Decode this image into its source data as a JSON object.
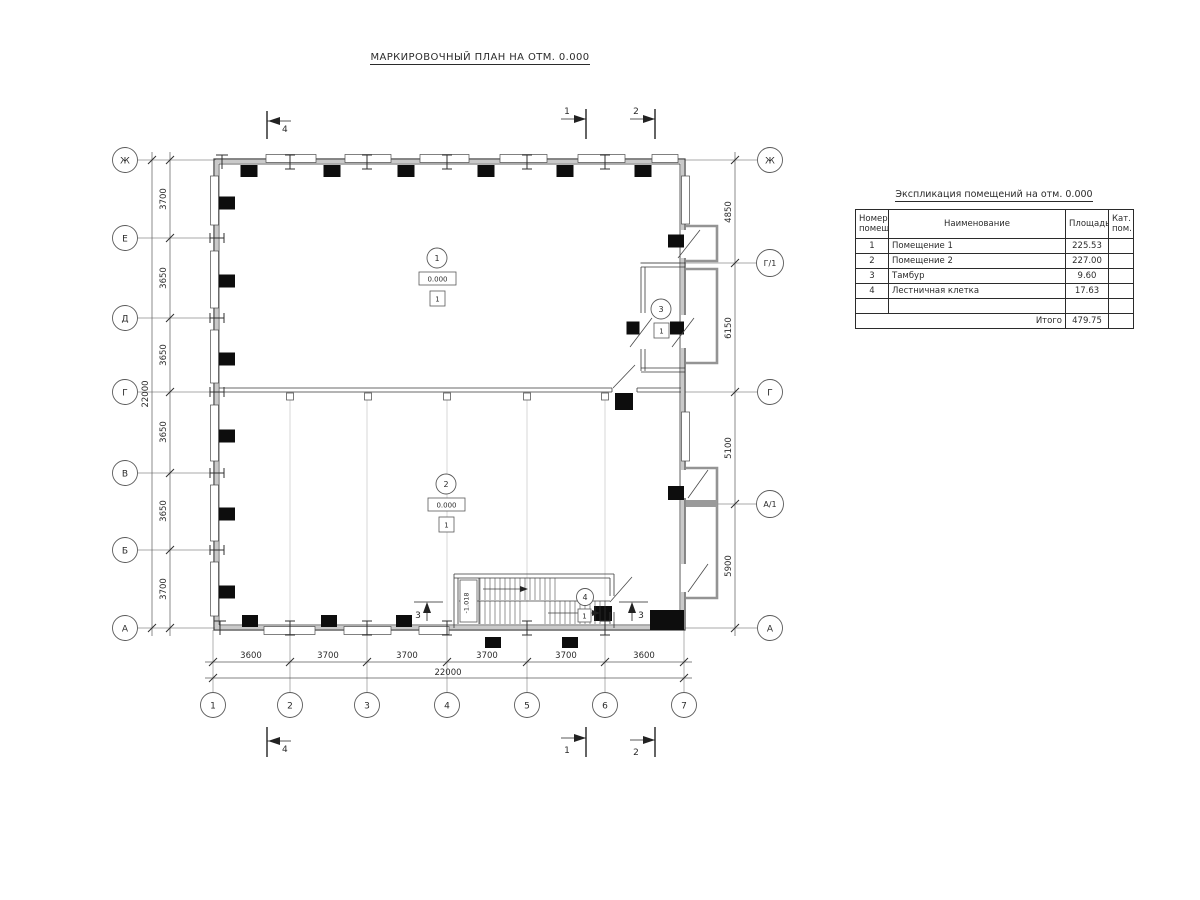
{
  "title": "МАРКИРОВОЧНЫЙ ПЛАН НА ОТМ. 0.000",
  "axes": {
    "left": [
      "Ж",
      "Е",
      "Д",
      "Г",
      "В",
      "Б",
      "А"
    ],
    "right": [
      "Ж",
      "Г/1",
      "Г",
      "А/1",
      "А"
    ],
    "bottom": [
      "1",
      "2",
      "3",
      "4",
      "5",
      "6",
      "7"
    ]
  },
  "dims": {
    "left": [
      "3700",
      "3650",
      "3650",
      "3650",
      "3650",
      "3700"
    ],
    "left_total": "22000",
    "right": [
      "4850",
      "6150",
      "5100",
      "5900"
    ],
    "bottom": [
      "3600",
      "3700",
      "3700",
      "3700",
      "3700",
      "3600"
    ],
    "bottom_total": "22000"
  },
  "rooms": {
    "r1": {
      "num": "1",
      "elev": "0.000",
      "floor": "1"
    },
    "r2": {
      "num": "2",
      "elev": "0.000",
      "floor": "1"
    },
    "r3": {
      "num": "3",
      "floor": "1"
    },
    "r4": {
      "num": "4",
      "floor": "1"
    }
  },
  "stair": {
    "landing_elevation": "-1.018"
  },
  "sections": {
    "s1": "1",
    "s2": "2",
    "s3": "3",
    "s4": "4"
  },
  "table": {
    "title": "Экспликация помещений на отм. 0.000",
    "headers": {
      "number": "Номер помещ.",
      "name": "Наименование",
      "area": "Площадь",
      "category": "Кат. пом."
    },
    "rows": [
      {
        "number": "1",
        "name": "Помещение 1",
        "area": "225.53",
        "category": ""
      },
      {
        "number": "2",
        "name": "Помещение 2",
        "area": "227.00",
        "category": ""
      },
      {
        "number": "3",
        "name": "Тамбур",
        "area": "9.60",
        "category": ""
      },
      {
        "number": "4",
        "name": "Лестничная клетка",
        "area": "17.63",
        "category": ""
      }
    ],
    "total_label": "Итого",
    "total_area": "479.75"
  }
}
